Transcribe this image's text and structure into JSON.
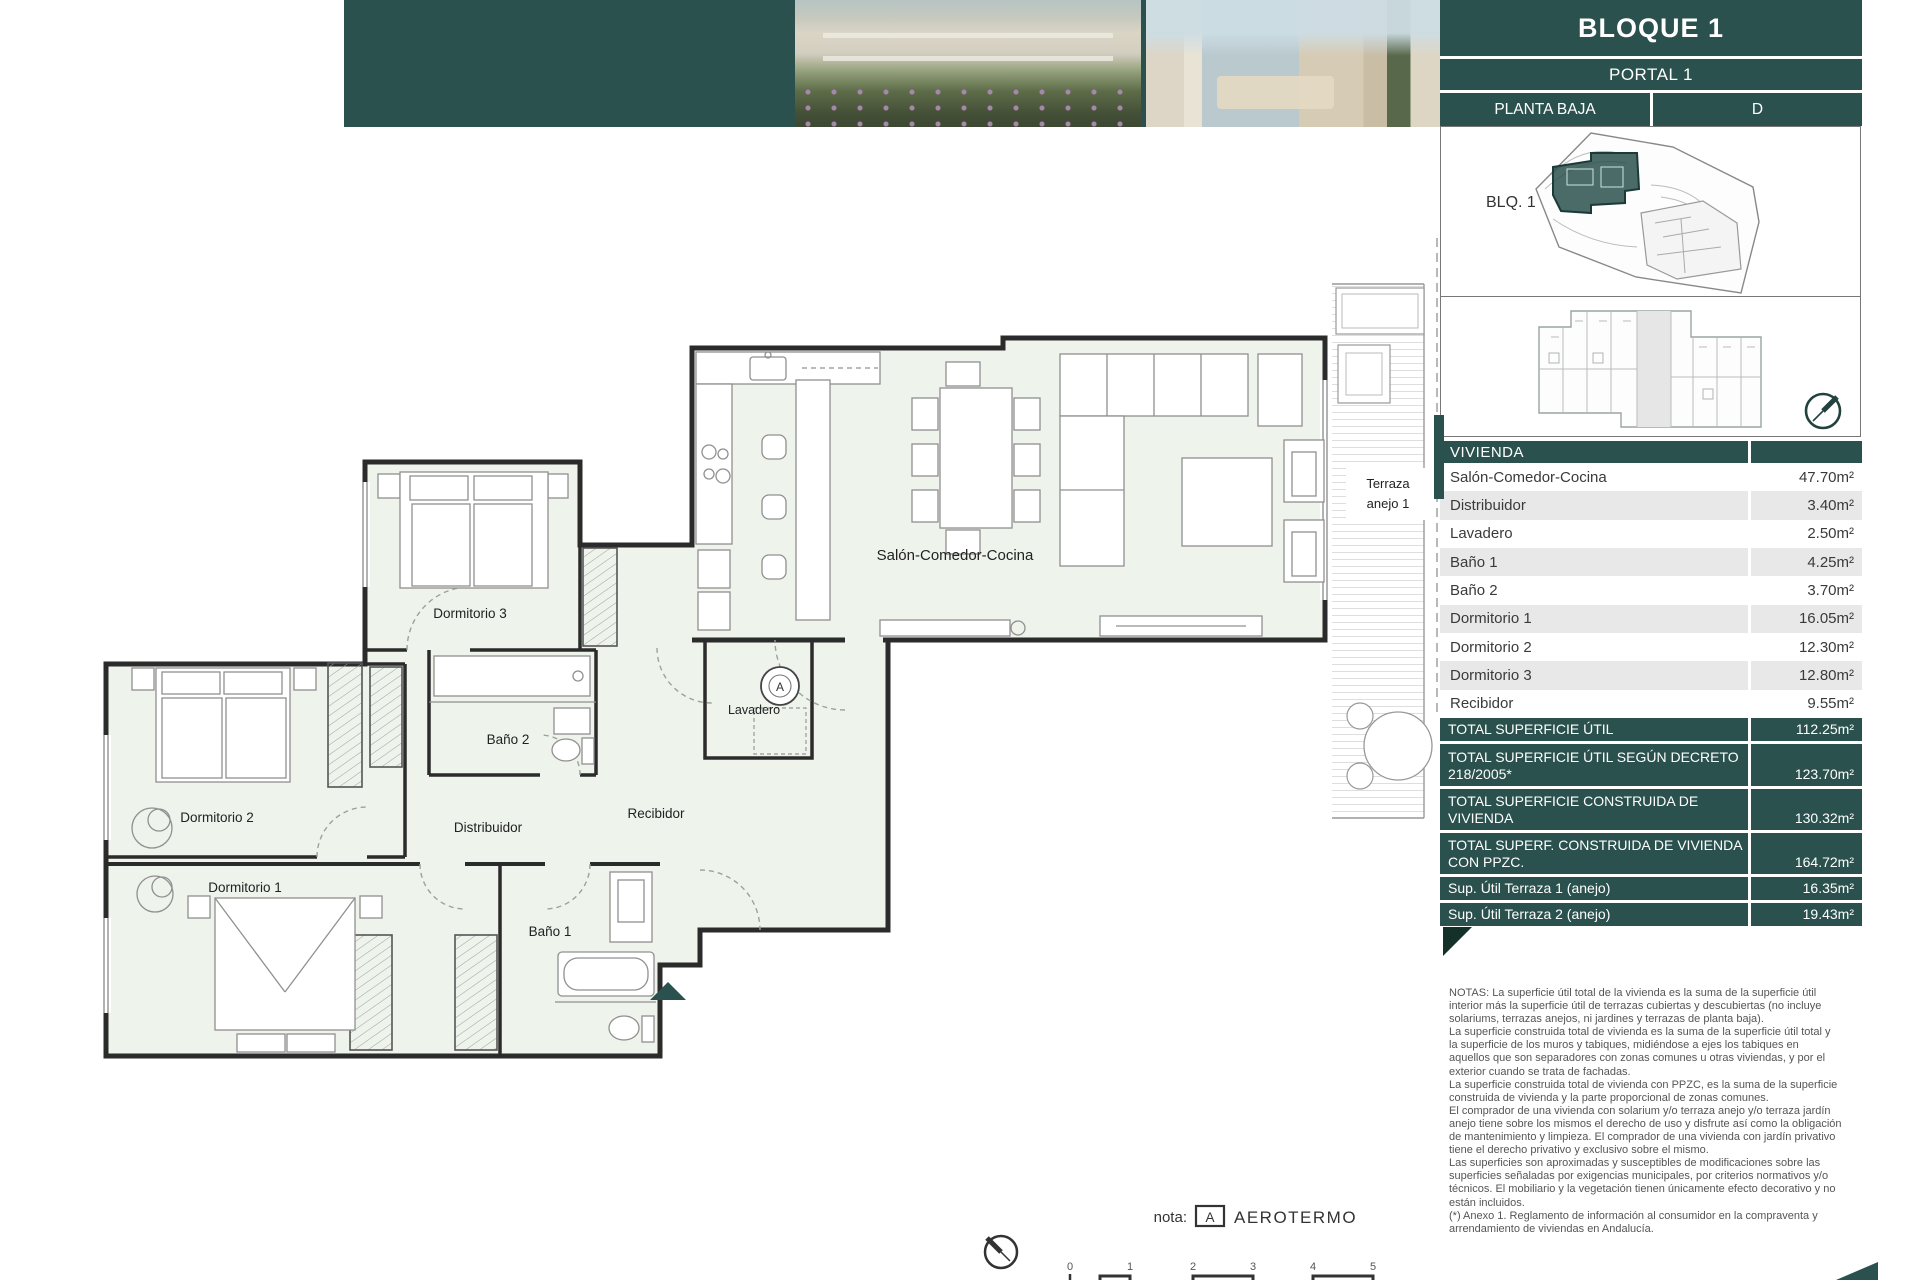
{
  "header": {
    "title": "BLOQUE 1",
    "portal": "PORTAL 1",
    "planta": "PLANTA BAJA",
    "letter": "D",
    "blq_label": "BLQ. 1"
  },
  "colors": {
    "teal": "#2a514d",
    "teal_dark": "#143028",
    "row_alt": "#e8e8e8",
    "plan_fill": "#eef3ec"
  },
  "vivienda": {
    "header": "VIVIENDA",
    "rows": [
      {
        "label": "Salón-Comedor-Cocina",
        "value": "47.70m²"
      },
      {
        "label": "Distribuidor",
        "value": "3.40m²"
      },
      {
        "label": "Lavadero",
        "value": "2.50m²"
      },
      {
        "label": "Baño 1",
        "value": "4.25m²"
      },
      {
        "label": "Baño 2",
        "value": "3.70m²"
      },
      {
        "label": "Dormitorio 1",
        "value": "16.05m²"
      },
      {
        "label": "Dormitorio 2",
        "value": "12.30m²"
      },
      {
        "label": "Dormitorio 3",
        "value": "12.80m²"
      },
      {
        "label": "Recibidor",
        "value": "9.55m²"
      }
    ]
  },
  "totals": [
    {
      "label": "TOTAL SUPERFICIE ÚTIL",
      "value": "112.25m²"
    },
    {
      "label": "TOTAL SUPERFICIE ÚTIL SEGÚN DECRETO 218/2005*",
      "value": "123.70m²"
    },
    {
      "label": "TOTAL SUPERFICIE CONSTRUIDA DE VIVIENDA",
      "value": "130.32m²"
    },
    {
      "label": "TOTAL SUPERF. CONSTRUIDA DE VIVIENDA CON PPZC.",
      "value": "164.72m²"
    },
    {
      "label": "Sup. Útil Terraza 1 (anejo)",
      "value": "16.35m²"
    },
    {
      "label": "Sup. Útil Terraza 2 (anejo)",
      "value": "19.43m²"
    }
  ],
  "notes": {
    "lines": [
      "NOTAS:        La superficie útil total de la vivienda es la suma de la superficie útil",
      "interior más la superficie útil de terrazas cubiertas y descubiertas (no incluye",
      "solariums, terrazas anejos, ni jardines y terrazas de planta baja).",
      "La superficie construida total de vivienda es la suma de la superficie útil total y",
      "la superficie de los muros y tabiques, midiéndose a ejes los tabiques en",
      "aquellos que son separadores con zonas comunes u otras viviendas, y por el",
      "exterior cuando se trata de fachadas.",
      "La superficie construida total de vivienda con PPZC, es la suma de la superficie",
      "construida de vivienda y la parte proporcional de zonas comunes.",
      "El comprador de una vivienda con solarium y/o terraza anejo y/o terraza jardín",
      "anejo tiene sobre los mismos el derecho de uso y disfrute así como la obligación",
      "de mantenimiento y limpieza. El comprador de una vivienda con jardín privativo",
      "tiene el derecho privativo y exclusivo sobre el mismo.",
      "Las superficies son aproximadas y susceptibles de modificaciones sobre las",
      "superficies señaladas por exigencias municipales, por criterios normativos y/o",
      "técnicos. El mobiliario y la vegetación tienen únicamente efecto decorativo y no",
      "están incluidos.",
      " (*) Anexo 1. Reglamento de información al consumidor en la compraventa y",
      "arrendamiento de viviendas en Andalucía."
    ]
  },
  "plan": {
    "labels": {
      "salon": "Salón-Comedor-Cocina",
      "dormitorio1": "Dormitorio 1",
      "dormitorio2": "Dormitorio 2",
      "dormitorio3": "Dormitorio 3",
      "bano1": "Baño 1",
      "bano2": "Baño 2",
      "distribuidor": "Distribuidor",
      "recibidor": "Recibidor",
      "lavadero": "Lavadero"
    },
    "terraza_line1": "Terraza",
    "terraza_line2": "anejo 1",
    "aerotermo_letter": "A"
  },
  "footer": {
    "nota_label": "nota:",
    "aerotermo_box": "A",
    "aerotermo_text": "AEROTERMO",
    "scale_ticks": [
      "0",
      "1",
      "2",
      "3",
      "4",
      "5"
    ]
  }
}
